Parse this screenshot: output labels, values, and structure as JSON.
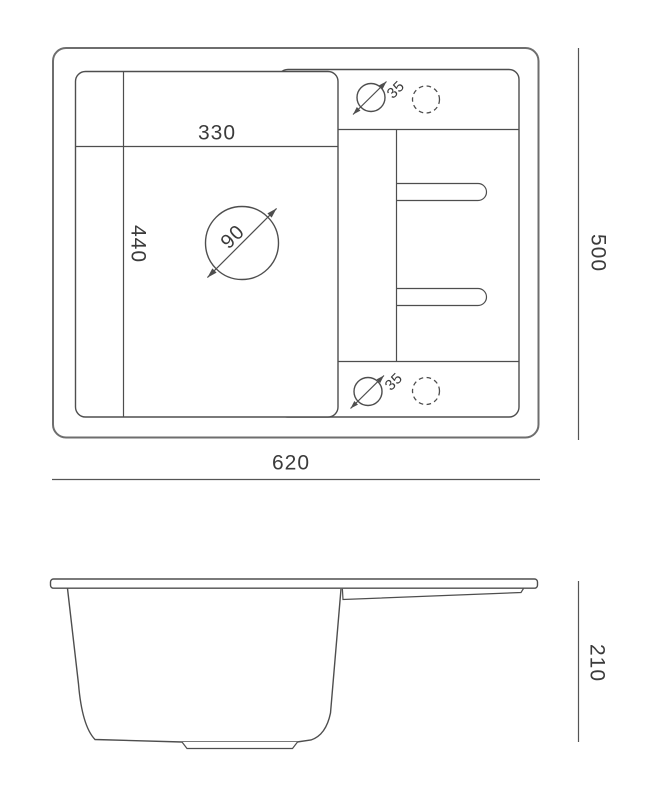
{
  "drawing": {
    "type": "sink-technical-drawing",
    "top_view": {
      "bowl_width": "330",
      "bowl_length": "440",
      "drain_diameter": "90",
      "faucet_hole_diameter_top": "35",
      "faucet_hole_diameter_bottom": "35"
    },
    "dimensions": {
      "overall_width": "620",
      "overall_depth": "500",
      "overall_height": "210"
    },
    "colors": {
      "line": "#4e4e4e",
      "outer_line": "#6e6e6e",
      "dimension_line": "#555555",
      "text": "#3b3b3b",
      "background": "#ffffff"
    }
  }
}
